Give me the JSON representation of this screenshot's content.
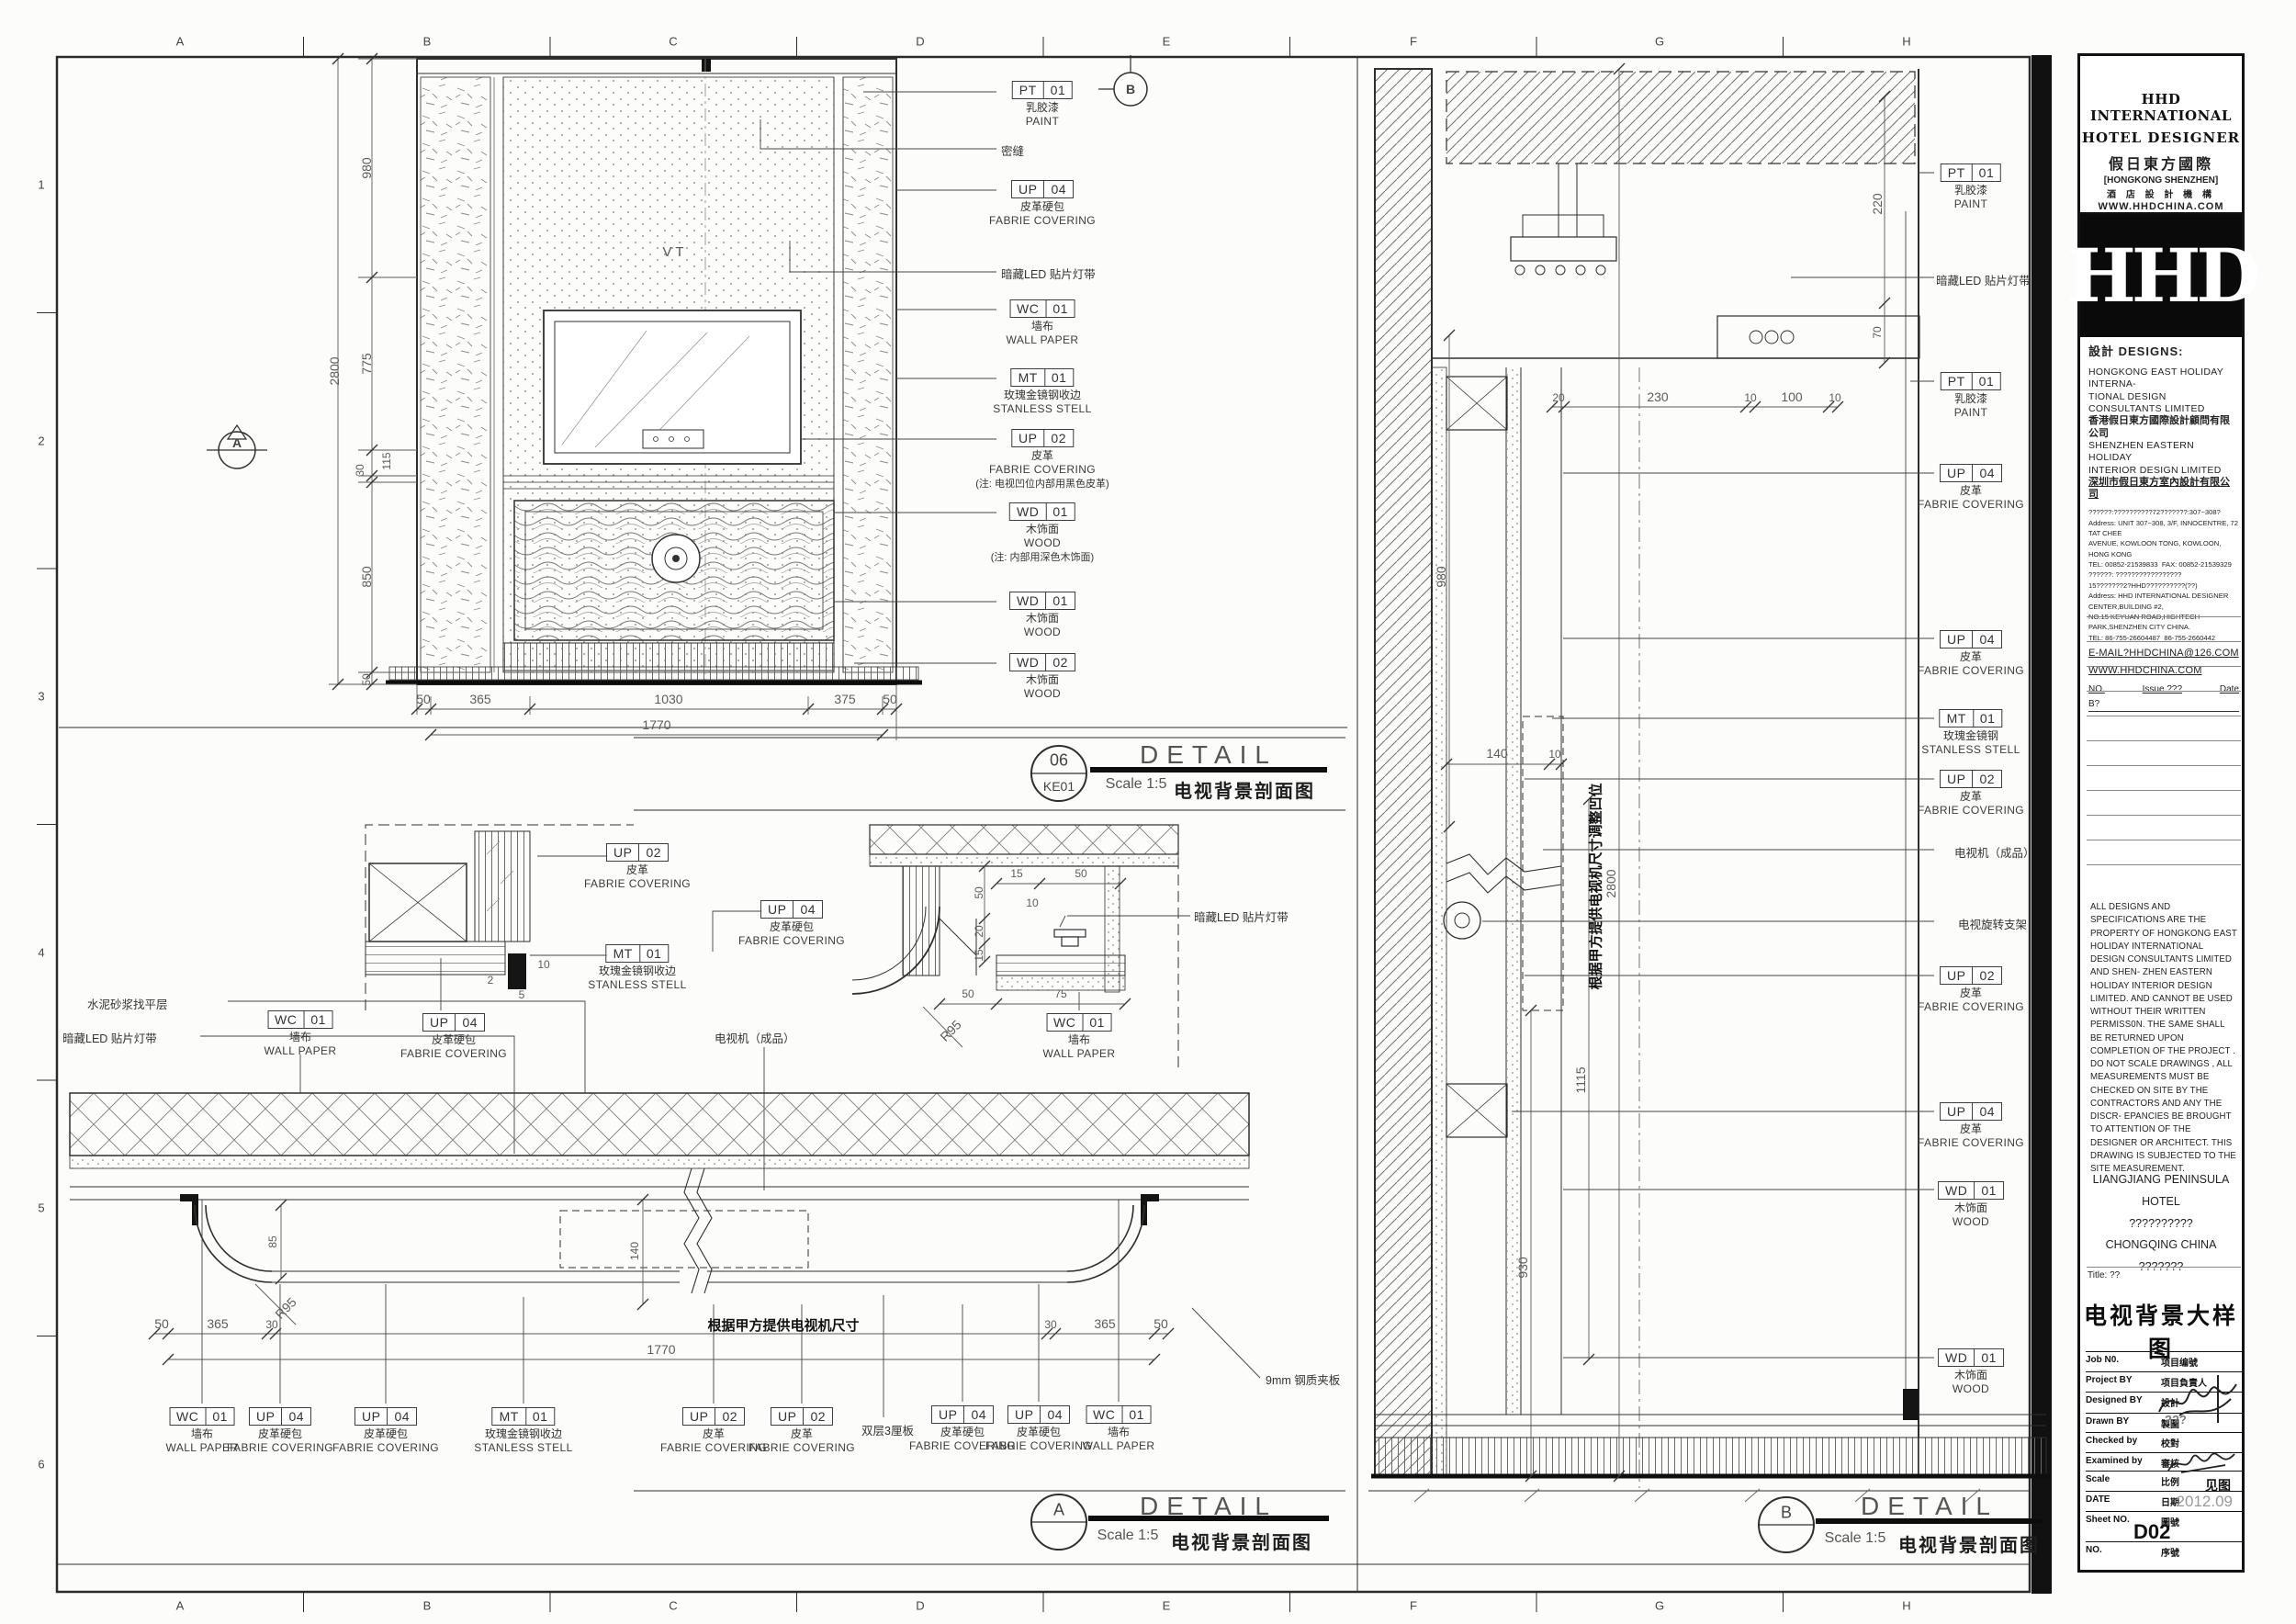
{
  "sheet": {
    "letters": [
      "A",
      "B",
      "C",
      "D",
      "E",
      "F",
      "G",
      "H"
    ],
    "numbers": [
      "1",
      "2",
      "3",
      "4",
      "5",
      "6"
    ]
  },
  "markers": {
    "a": "A",
    "b": "B"
  },
  "titles": {
    "d1": {
      "num": "06",
      "sub": "KE01",
      "detail": "DETAIL",
      "scale": "Scale 1:5",
      "cn": "电视背景剖面图"
    },
    "dA": {
      "num": "A",
      "detail": "DETAIL",
      "scale": "Scale 1:5",
      "cn": "电视背景剖面图"
    },
    "dB": {
      "num": "B",
      "detail": "DETAIL",
      "scale": "Scale 1:5",
      "cn": "电视背景剖面图"
    }
  },
  "d1": {
    "glass": "V T",
    "tags": [
      {
        "c1": "PT",
        "c2": "01",
        "cn": "乳胶漆",
        "en": "PAINT"
      },
      {
        "c1": "UP",
        "c2": "04",
        "cn": "皮革硬包",
        "en": "FABRIE COVERING"
      },
      {
        "c1": "WC",
        "c2": "01",
        "cn": "墙布",
        "en": "WALL PAPER"
      },
      {
        "c1": "MT",
        "c2": "01",
        "cn": "玫瑰金镜钢收边",
        "en": "STANLESS STELL"
      },
      {
        "c1": "UP",
        "c2": "02",
        "cn": "皮革",
        "en": "FABRIE COVERING",
        "note": "(注: 电视凹位内部用黑色皮革)"
      },
      {
        "c1": "WD",
        "c2": "01",
        "cn": "木饰面",
        "en": "WOOD",
        "note": "(注: 内部用深色木饰面)"
      },
      {
        "c1": "WD",
        "c2": "01",
        "cn": "木饰面",
        "en": "WOOD"
      },
      {
        "c1": "WD",
        "c2": "02",
        "cn": "木饰面",
        "en": "WOOD"
      }
    ],
    "notes": {
      "mifeng": "密缝",
      "led": "暗藏LED 贴片灯带"
    },
    "dims": {
      "v1": "980",
      "v2": "775",
      "v3": "115",
      "v4": "30",
      "v5": "850",
      "v6": "50",
      "ov": "2800",
      "h1": "50",
      "h2": "365",
      "h3": "1030",
      "h4": "375",
      "h5": "50",
      "oh": "1770"
    }
  },
  "dA": {
    "tags": [
      {
        "c1": "UP",
        "c2": "02",
        "cn": "皮革",
        "en": "FABRIE COVERING"
      },
      {
        "c1": "MT",
        "c2": "01",
        "cn": "玫瑰金镜钢收边",
        "en": "STANLESS STELL"
      },
      {
        "c1": "UP",
        "c2": "04",
        "cn": "皮革硬包",
        "en": "FABRIE COVERING"
      },
      {
        "c1": "UP",
        "c2": "04",
        "cn": "皮革硬包",
        "en": "FABRIE COVERING"
      },
      {
        "c1": "WC",
        "c2": "01",
        "cn": "墙布",
        "en": "WALL PAPER"
      },
      {
        "c1": "WC",
        "c2": "01",
        "cn": "墙布",
        "en": "WALL PAPER"
      },
      {
        "c1": "WC",
        "c2": "01",
        "cn": "墙布",
        "en": "WALL PAPER"
      },
      {
        "c1": "UP",
        "c2": "04",
        "cn": "皮革硬包",
        "en": "FABRIE COVERING"
      },
      {
        "c1": "UP",
        "c2": "04",
        "cn": "皮革硬包",
        "en": "FABRIE COVERING"
      },
      {
        "c1": "MT",
        "c2": "01",
        "cn": "玫瑰金镜钢收边",
        "en": "STANLESS STELL"
      },
      {
        "c1": "UP",
        "c2": "02",
        "cn": "皮革",
        "en": "FABRIE COVERING"
      },
      {
        "c1": "UP",
        "c2": "02",
        "cn": "皮革",
        "en": "FABRIE COVERING"
      },
      {
        "c1": "UP",
        "c2": "04",
        "cn": "皮革硬包",
        "en": "FABRIE COVERING"
      },
      {
        "c1": "UP",
        "c2": "04",
        "cn": "皮革硬包",
        "en": "FABRIE COVERING"
      },
      {
        "c1": "WC",
        "c2": "01",
        "cn": "墙布",
        "en": "WALL PAPER"
      }
    ],
    "notes": {
      "cement": "水泥砂浆找平层",
      "led1": "暗藏LED 贴片灯带",
      "led2": "暗藏LED 贴片灯带",
      "tv": "电视机（成品）",
      "ply": "双层3厘板",
      "steel": "9mm 钢质夹板",
      "bold": "根据甲方提供电视机尺寸"
    },
    "dims": {
      "s10": "10",
      "s5": "5",
      "s2": "2",
      "v50": "50",
      "v20": "20",
      "v15": "15",
      "h15": "15",
      "h10": "10",
      "h50": "50",
      "b50": "50",
      "b75": "75",
      "r95a": "R95",
      "d85": "85",
      "d140": "140",
      "r95b": "R95",
      "c50a": "50",
      "c365a": "365",
      "c30a": "30",
      "c30b": "30",
      "c365b": "365",
      "c50b": "50",
      "c1770": "1770"
    }
  },
  "dB": {
    "tags": [
      {
        "c1": "PT",
        "c2": "01",
        "cn": "乳胶漆",
        "en": "PAINT"
      },
      {
        "c1": "PT",
        "c2": "01",
        "cn": "乳胶漆",
        "en": "PAINT"
      },
      {
        "c1": "UP",
        "c2": "04",
        "cn": "皮革",
        "en": "FABRIE COVERING"
      },
      {
        "c1": "UP",
        "c2": "04",
        "cn": "皮革",
        "en": "FABRIE COVERING"
      },
      {
        "c1": "MT",
        "c2": "01",
        "cn": "玫瑰金镜钢",
        "en": "STANLESS STELL"
      },
      {
        "c1": "UP",
        "c2": "02",
        "cn": "皮革",
        "en": "FABRIE COVERING"
      },
      {
        "c1": "UP",
        "c2": "02",
        "cn": "皮革",
        "en": "FABRIE COVERING"
      },
      {
        "c1": "UP",
        "c2": "04",
        "cn": "皮革",
        "en": "FABRIE COVERING"
      },
      {
        "c1": "WD",
        "c2": "01",
        "cn": "木饰面",
        "en": "WOOD"
      },
      {
        "c1": "WD",
        "c2": "01",
        "cn": "木饰面",
        "en": "WOOD"
      }
    ],
    "notes": {
      "led": "暗藏LED 贴片灯带",
      "tv": "电视机（成品）",
      "pivot": "电视旋转支架",
      "bold": "根据甲方提供电视机尺寸调整凹位"
    },
    "dims": {
      "d220": "220",
      "d70": "70",
      "c20": "20",
      "c230": "230",
      "c10a": "10",
      "c100": "100",
      "c10b": "10",
      "d980": "980",
      "d2800": "2800",
      "d1115": "1115",
      "d930": "930",
      "d140": "140",
      "d10": "10"
    }
  },
  "tb": {
    "header": {
      "l1": "HHD INTERNATIONAL",
      "l2": "HOTEL DESIGNER",
      "l3": "假日東方國際",
      "l4": "[HONGKONG SHENZHEN]",
      "l5": "酒 店 設 計 機 構",
      "l6": "WWW.HHDCHINA.COM"
    },
    "logo": "HHD",
    "designs_label": "設計 DESIGNS:",
    "co1_en1": "HONGKONG EAST HOLIDAY INTERNA-",
    "co1_en2": "TIONAL DESIGN CONSULTANTS LIMITED",
    "co1_cn": "香港假日東方國際設計顧問有限公司",
    "co2_en1": "SHENZHEN EASTERN HOLIDAY",
    "co2_en2": "INTERIOR DESIGN LIMITED",
    "co2_cn": "深圳市假日東方室內設計有限公司",
    "addr1_cn": "??????:??????????72???????:307~308?",
    "addr1_1": "Address: UNIT 307~308, 3/F, INNOCENTRE, 72 TAT CHEE",
    "addr1_2": "AVENUE, KOWLOON TONG, KOWLOON, HONG KONG",
    "addr1_tel": "TEL: 00852-21539833",
    "addr1_fax": "FAX: 00852-21539329",
    "addr2_cn1": "??????: ?????????????????",
    "addr2_cn2": "15???????2?HHD??????????(??)",
    "addr2_1": "Address: HHD INTERNATIONAL DESIGNER CENTER,BUILDING #2,",
    "addr2_2": "NO.15 KEYUAN ROAD,HIGHTECH PARK,SHENZHEN CITY CHINA.",
    "addr2_tel": "TEL: 86-755-26604487",
    "addr2_fax": "86-755-2660442",
    "email": "E-MAIL?HHDCHINA@126.COM",
    "www": "WWW.HHDCHINA.COM",
    "issue_no": "NO.",
    "issue_label": "Issue ???",
    "issue_date": "Date",
    "issue_b": "B?",
    "legal": "ALL DESIGNS AND SPECIFICATIONS ARE THE PROPERTY OF HONGKONG EAST HOLIDAY INTERNATIONAL DESIGN CONSULTANTS LIMITED AND SHEN- ZHEN EASTERN HOLIDAY INTERIOR DESIGN LIMITED. AND CANNOT BE USED WITHOUT THEIR WRITTEN PERMISS0N. THE SAME SHALL BE RETURNED UPON COMPLETION OF THE PROJECT . DO NOT SCALE DRAWINGS , ALL MEASUREMENTS MUST BE CHECKED ON SITE BY THE CONTRACTORS AND ANY THE DISCR- EPANCIES BE BROUGHT TO ATTENTION OF THE DESIGNER OR ARCHITECT. THIS DRAWING IS SUBJECTED TO THE SITE MEASUREMENT.",
    "project1": "LIANGJIANG PENINSULA HOTEL",
    "project2": "??????????",
    "project3": "CHONGQING CHINA",
    "project4": "???????",
    "title_label": "Title: ??",
    "sheet_title": "电视背景大样图",
    "rows": [
      {
        "en": "Job N0.",
        "cn": "项目编號"
      },
      {
        "en": "Project BY",
        "cn": "项目負責人"
      },
      {
        "en": "Designed BY",
        "cn": "設計"
      },
      {
        "en": "Drawn BY",
        "cn": "製圖"
      },
      {
        "en": "Checked by",
        "cn": "校對"
      },
      {
        "en": "Examined by",
        "cn": "審核"
      },
      {
        "en": "Scale",
        "cn": "比例"
      },
      {
        "en": "DATE",
        "cn": "日期"
      },
      {
        "en": "Sheet NO.",
        "cn": "圖號"
      },
      {
        "en": "NO.",
        "cn": "序號"
      }
    ],
    "drawn_val": "???",
    "scale_val": "见图",
    "date_val": "2012.09",
    "sheet_val": "D02"
  }
}
